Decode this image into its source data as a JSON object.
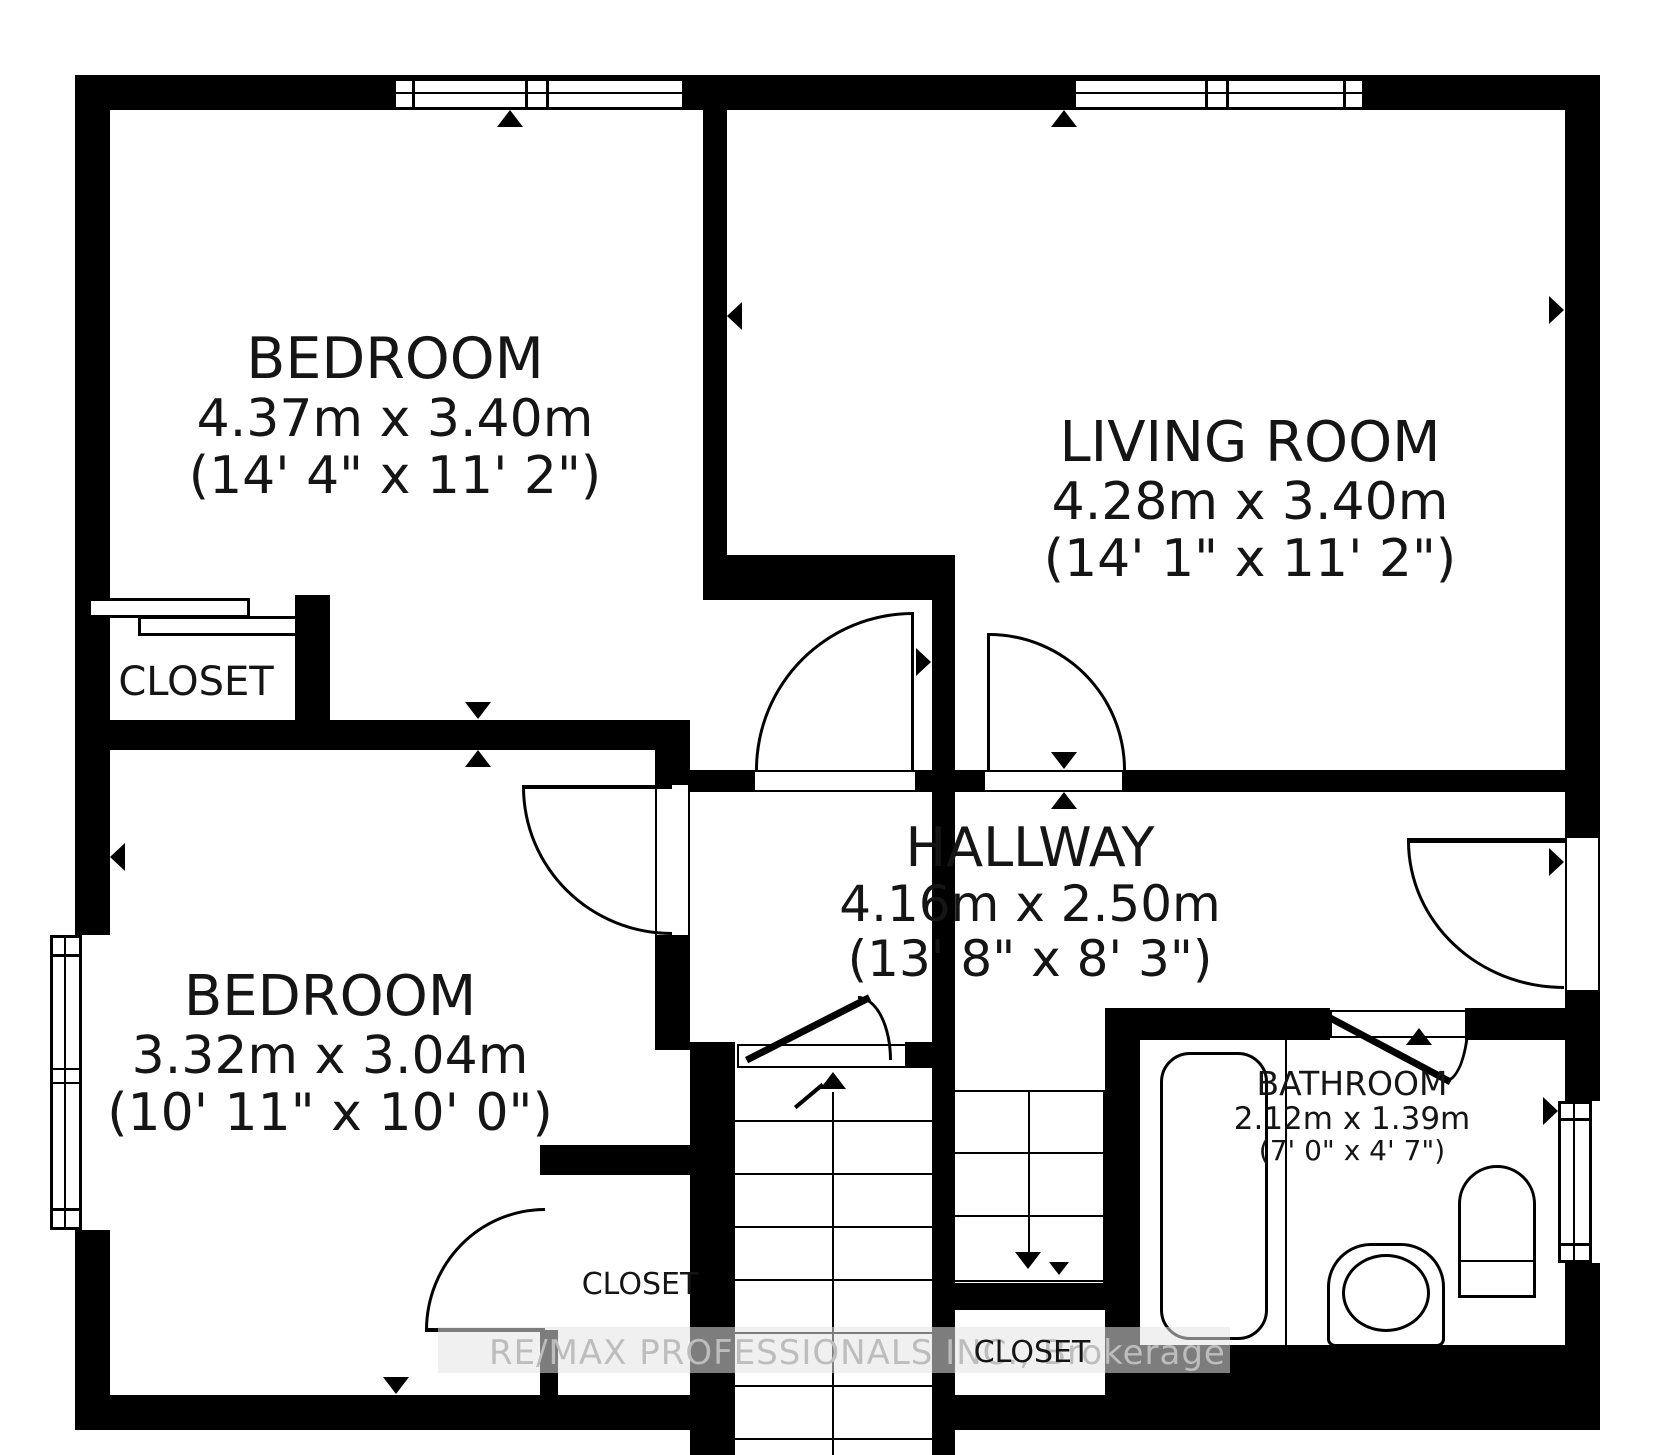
{
  "colors": {
    "wall": "#000000",
    "background": "#ffffff",
    "watermark_text": "#bdbdbd"
  },
  "rooms": [
    {
      "name": "BEDROOM",
      "dims_metric": "4.37m x 3.40m",
      "dims_imperial": "(14' 4\" x 11' 2\")"
    },
    {
      "name": "LIVING ROOM",
      "dims_metric": "4.28m x 3.40m",
      "dims_imperial": "(14' 1\" x 11' 2\")"
    },
    {
      "name": "BEDROOM",
      "dims_metric": "3.32m x 3.04m",
      "dims_imperial": "(10' 11\" x 10' 0\")"
    },
    {
      "name": "HALLWAY",
      "dims_metric": "4.16m x 2.50m",
      "dims_imperial": "(13' 8\" x 8' 3\")"
    },
    {
      "name": "BATHROOM",
      "dims_metric": "2.12m x 1.39m",
      "dims_imperial": "(7' 0\" x 4' 7\")"
    }
  ],
  "closets": [
    {
      "label": "CLOSET"
    },
    {
      "label": "CLOSET"
    },
    {
      "label": "CLOSET"
    }
  ],
  "watermark": {
    "text": "RE/MAX PROFESSIONALS INC., Brokerage"
  }
}
